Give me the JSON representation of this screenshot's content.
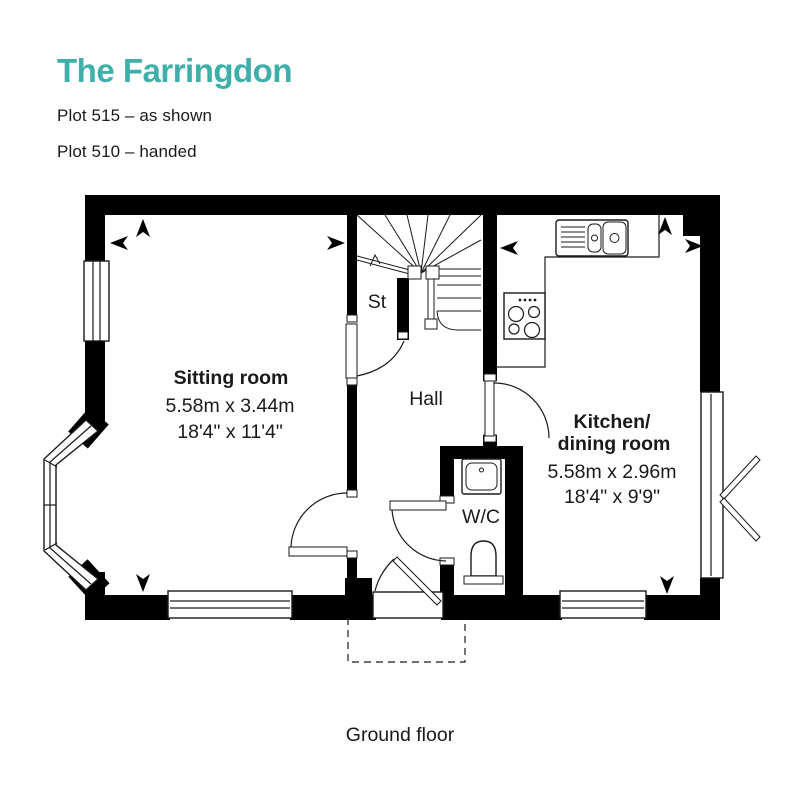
{
  "header": {
    "title": "The Farringdon",
    "plot_line_1": "Plot 515 – as shown",
    "plot_line_2": "Plot 510 – handed",
    "accent_color": "#3fafaa"
  },
  "rooms": {
    "sitting": {
      "name": "Sitting room",
      "metric": "5.58m x 3.44m",
      "imperial": "18'4\" x 11'4\""
    },
    "kitchen": {
      "name_line1": "Kitchen/",
      "name_line2": "dining room",
      "metric": "5.58m x 2.96m",
      "imperial": "18'4\" x 9'9\""
    },
    "hall": {
      "name": "Hall"
    },
    "storage": {
      "name": "St"
    },
    "wc": {
      "name": "W/C"
    }
  },
  "footer": {
    "floor_label": "Ground floor"
  }
}
